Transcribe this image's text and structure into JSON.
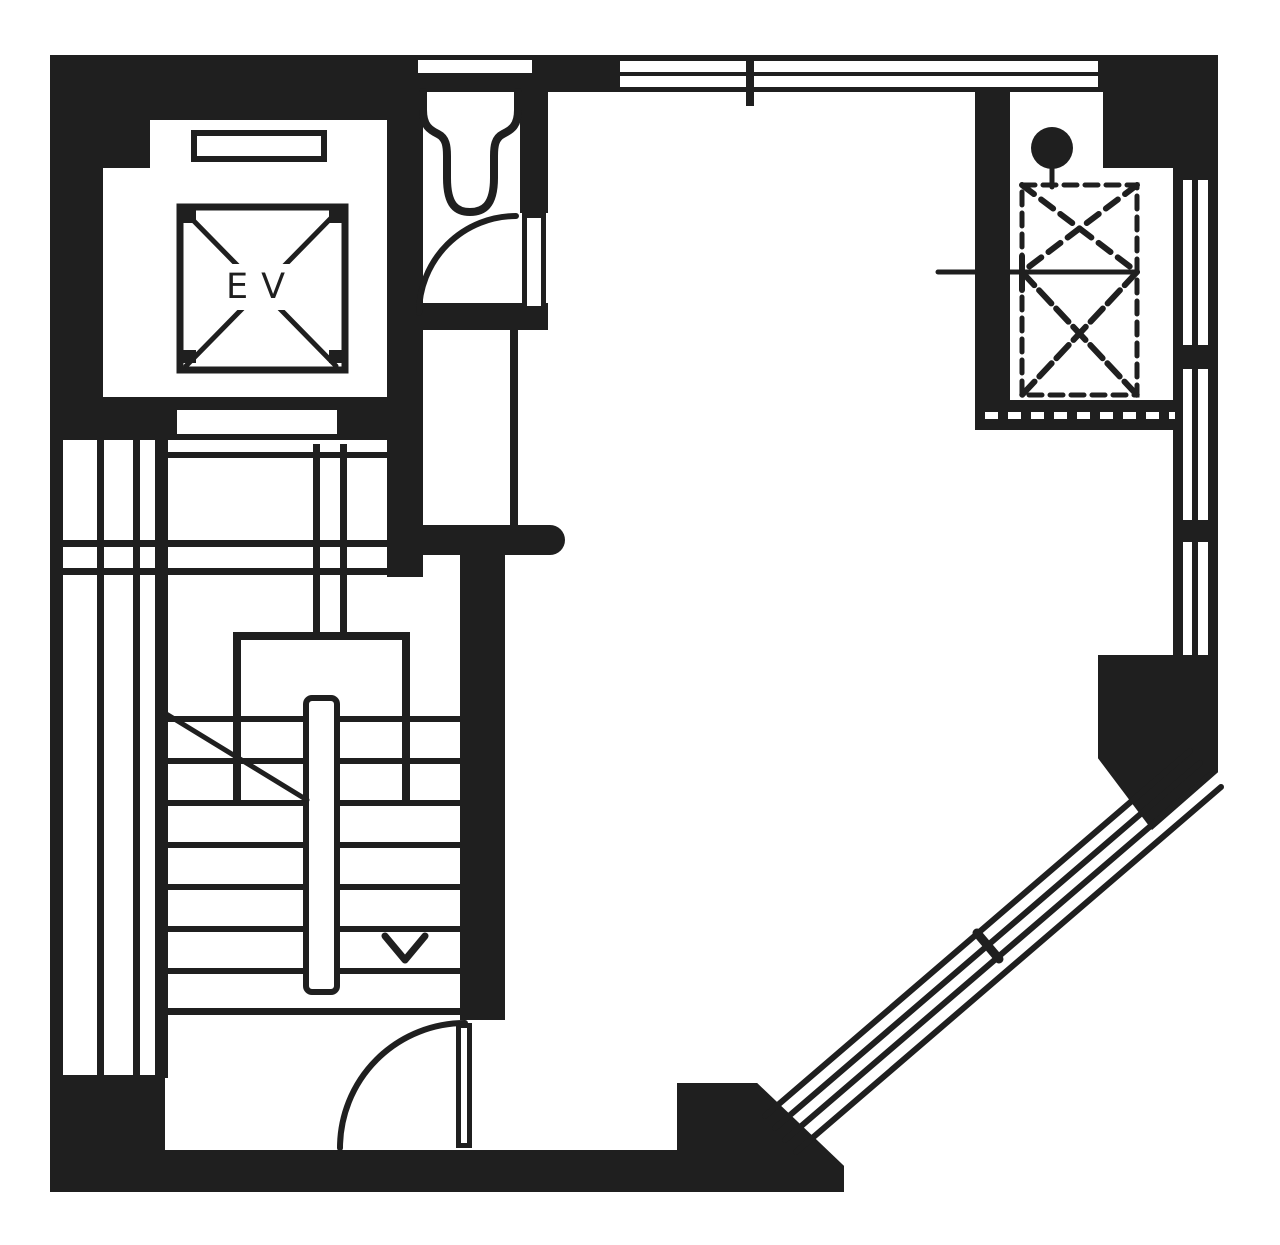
{
  "document": {
    "type": "architectural floor plan",
    "style": "black ink poche on white paper",
    "orientation": "chamfered corner at bottom-right"
  },
  "colors": {
    "ink": "#1f1f1f",
    "paper": "#ffffff"
  },
  "elevator": {
    "label": "EV"
  },
  "rooms": [
    {
      "id": "elevator-shaft",
      "label": "EV",
      "features": [
        "x-shaft-mark",
        "corner-pads",
        "door-sill",
        "door-opening-in-south-wall"
      ]
    },
    {
      "id": "toilet-room",
      "features": [
        "toilet-bowl",
        "door-swing-arc",
        "door-leaf",
        "wall-vent-slot"
      ]
    },
    {
      "id": "washroom",
      "features": [
        "round-basin",
        "rectangular-basin",
        "thin-partition"
      ]
    },
    {
      "id": "stair-hall",
      "features": [
        "u-return-stair",
        "center-handrail",
        "treads",
        "landing-line",
        "break-line",
        "down-arrow",
        "entry-door-swing-arc"
      ]
    },
    {
      "id": "duct-shaft",
      "features": [
        "riser-circle",
        "dashed-x-duct-upper",
        "dashed-x-duct-lower",
        "center-reference-tick",
        "hatched-sill-band"
      ]
    },
    {
      "id": "main-room",
      "features": [
        "open-floor-area"
      ]
    }
  ],
  "windows": [
    {
      "id": "top-wall-window-band",
      "side": "north",
      "panes": 2,
      "mullion_ticks": 1
    },
    {
      "id": "left-wall-window-band",
      "side": "west",
      "glazing_lines": 2
    },
    {
      "id": "right-wall-window-band",
      "side": "east",
      "glazing_lines": 1,
      "dividers": 2
    },
    {
      "id": "chamfer-window-band",
      "side": "south-east diagonal",
      "glazing_lines": 4,
      "mullion_ticks": 1
    }
  ],
  "stair": {
    "treads_per_flight": 7,
    "direction_mark": "down-arrow",
    "handrail": "central white bar"
  }
}
